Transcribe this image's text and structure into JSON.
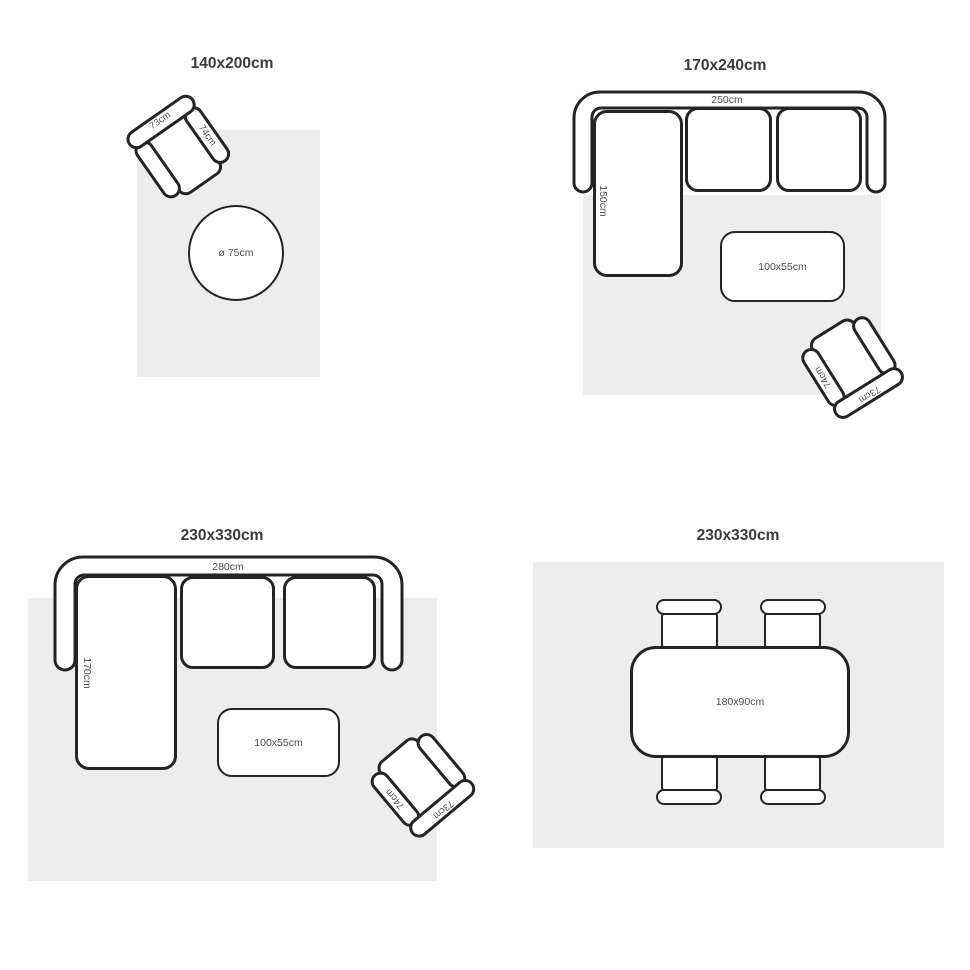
{
  "figure_title": "Rug size guide with furniture layouts",
  "colors": {
    "outline": "#242424",
    "rug": "#ededed",
    "title_text": "#3b3b3b",
    "dimension_text": "#4d4d4d"
  },
  "panels": [
    {
      "title": "140x200cm",
      "armchair_back": "73cm",
      "armchair_arm": "74cm",
      "round_table": "ø 75cm"
    },
    {
      "title": "170x240cm",
      "sofa_width": "250cm",
      "sofa_chaise": "150cm",
      "coffee_table": "100x55cm",
      "armchair_back": "73cm",
      "armchair_arm": "74cm"
    },
    {
      "title": "230x330cm",
      "sofa_width": "280cm",
      "sofa_chaise": "170cm",
      "coffee_table": "100x55cm",
      "armchair_back": "73cm",
      "armchair_arm": "74cm"
    },
    {
      "title": "230x330cm",
      "dining_table": "180x90cm"
    }
  ]
}
